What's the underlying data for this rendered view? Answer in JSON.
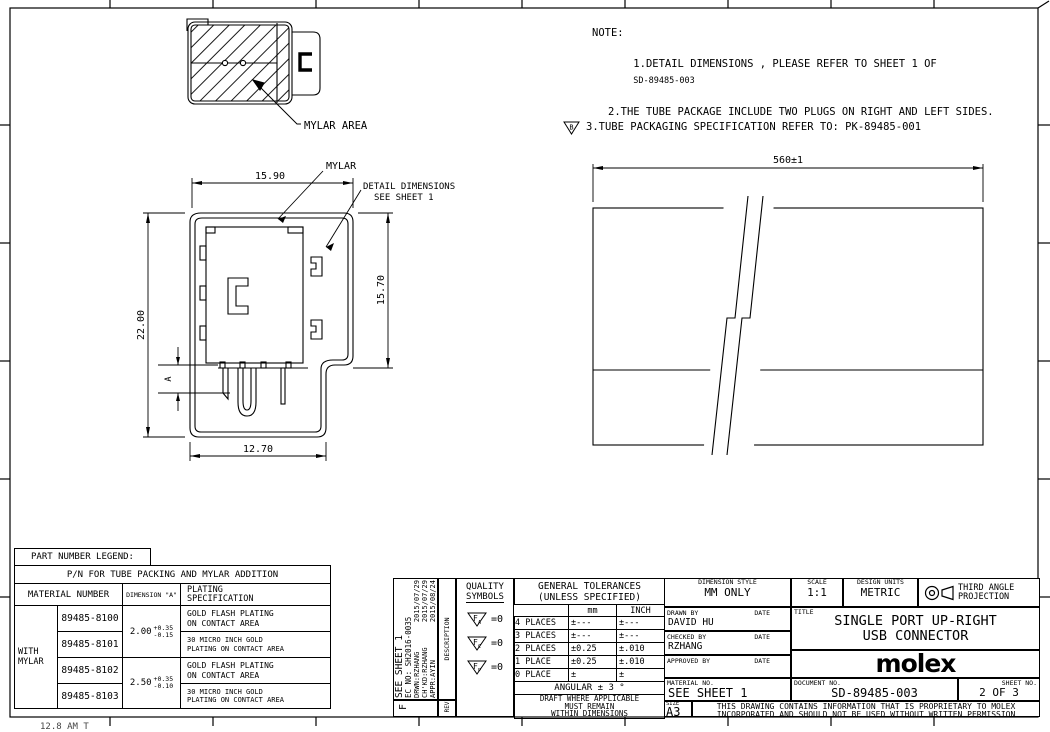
{
  "accent_color": "#000000",
  "notes": {
    "heading": "NOTE:",
    "line1": "1.DETAIL DIMENSIONS , PLEASE REFER TO SHEET 1 OF",
    "line1_doc": "SD-89485-003",
    "line2": "2.THE TUBE PACKAGE INCLUDE TWO PLUGS ON RIGHT AND LEFT SIDES.",
    "line3": "3.TUBE PACKAGING SPECIFICATION REFER TO: PK-89485-001",
    "line3_flag": "B"
  },
  "mylar_view": {
    "label": "MYLAR AREA"
  },
  "front_view": {
    "dim_top": "15.90",
    "dim_left": "22.00",
    "dim_right": "15.70",
    "dim_bottom": "12.70",
    "dim_a": "A",
    "mylar_label": "MYLAR",
    "detail_label_1": "DETAIL DIMENSIONS",
    "detail_label_2": "SEE SHEET 1"
  },
  "tube_view": {
    "dim_length": "560±1"
  },
  "legend": {
    "title": "PART NUMBER LEGEND:",
    "subtitle": "P/N FOR TUBE PACKING AND MYLAR ADDITION",
    "headers": {
      "material": "MATERIAL NUMBER",
      "dimension": "DIMENSION \"A\"",
      "plating1": "PLATING",
      "plating2": "SPECIFICATION"
    },
    "group_label_1": "WITH",
    "group_label_2": "MYLAR",
    "parts": [
      "89485-8100",
      "89485-8101",
      "89485-8102",
      "89485-8103"
    ],
    "dims": [
      {
        "base": "2.00",
        "plus": "+0.35",
        "minus": "-0.15"
      },
      {
        "base": "2.50",
        "plus": "+0.35",
        "minus": "-0.10"
      }
    ],
    "platings": [
      {
        "l1": "GOLD FLASH PLATING",
        "l2": "ON CONTACT AREA"
      },
      {
        "l1": "30 MICRO INCH GOLD",
        "l2": "PLATING ON CONTACT AREA"
      },
      {
        "l1": "GOLD FLASH PLATING",
        "l2": "ON CONTACT AREA"
      },
      {
        "l1": "30 MICRO INCH GOLD",
        "l2": "PLATING ON CONTACT AREA"
      }
    ]
  },
  "revision": {
    "sheet_ref": "SEE SHEET 1",
    "ec_no": "EC NO: SH2016-0035",
    "drwn_label": "DRWN:RZHANG",
    "drwn_date": "2015/07/29",
    "chkd_label": "CH'KD:RZHANG",
    "chkd_date": "2015/07/29",
    "appr_label": "APPR:AYIN",
    "appr_date": "2015/08/24",
    "description_label": "DESCRIPTION",
    "rev_label": "REV",
    "rev_value": "F"
  },
  "quality": {
    "title1": "QUALITY",
    "title2": "SYMBOLS",
    "symbols": [
      {
        "f": "F",
        "sub": "A",
        "eq": "=0"
      },
      {
        "f": "F",
        "sub": "C",
        "eq": "=0"
      },
      {
        "f": "F",
        "sub": "P",
        "eq": "=0"
      }
    ]
  },
  "tolerances": {
    "title1": "GENERAL TOLERANCES",
    "title2": "(UNLESS SPECIFIED)",
    "col_mm": "mm",
    "col_inch": "INCH",
    "rows": [
      {
        "label": "4 PLACES",
        "mm": "±---",
        "inch": "±---"
      },
      {
        "label": "3 PLACES",
        "mm": "±---",
        "inch": "±---"
      },
      {
        "label": "2 PLACES",
        "mm": "±0.25",
        "inch": "±.010"
      },
      {
        "label": "1 PLACE",
        "mm": "±0.25",
        "inch": "±.010"
      },
      {
        "label": "0 PLACE",
        "mm": "±",
        "inch": "±"
      }
    ],
    "angular": "ANGULAR ± 3 °",
    "draft1": "DRAFT WHERE APPLICABLE",
    "draft2": "MUST REMAIN",
    "draft3": "WITHIN DIMENSIONS"
  },
  "titleblock": {
    "dimension_style_label": "DIMENSION STYLE",
    "dimension_style": "MM ONLY",
    "scale_label": "SCALE",
    "scale": "1:1",
    "design_units_label": "DESIGN UNITS",
    "design_units": "METRIC",
    "projection_label_1": "THIRD ANGLE",
    "projection_label_2": "PROJECTION",
    "drawn_by_label": "DRAWN BY",
    "date_label": "DATE",
    "drawn_by": "DAVID HU",
    "checked_by_label": "CHECKED BY",
    "checked_by": "RZHANG",
    "approved_by_label": "APPROVED BY",
    "title_label": "TITLE",
    "title_line1": "SINGLE PORT UP-RIGHT",
    "title_line2": "USB CONNECTOR",
    "logo": "molex",
    "material_no_label": "MATERIAL NO.",
    "material_no": "SEE SHEET 1",
    "document_no_label": "DOCUMENT NO.",
    "document_no": "SD-89485-003",
    "sheet_no_label": "SHEET NO.",
    "sheet_no": "2 OF 3",
    "size_label": "SIZE",
    "size": "A3",
    "disclaimer1": "THIS DRAWING CONTAINS INFORMATION THAT IS PROPRIETARY TO MOLEX",
    "disclaimer2": "INCORPORATED AND SHOULD NOT BE USED WITHOUT WRITTEN PERMISSION"
  },
  "frame": {
    "footer_fragment": "12.8 AM T"
  }
}
